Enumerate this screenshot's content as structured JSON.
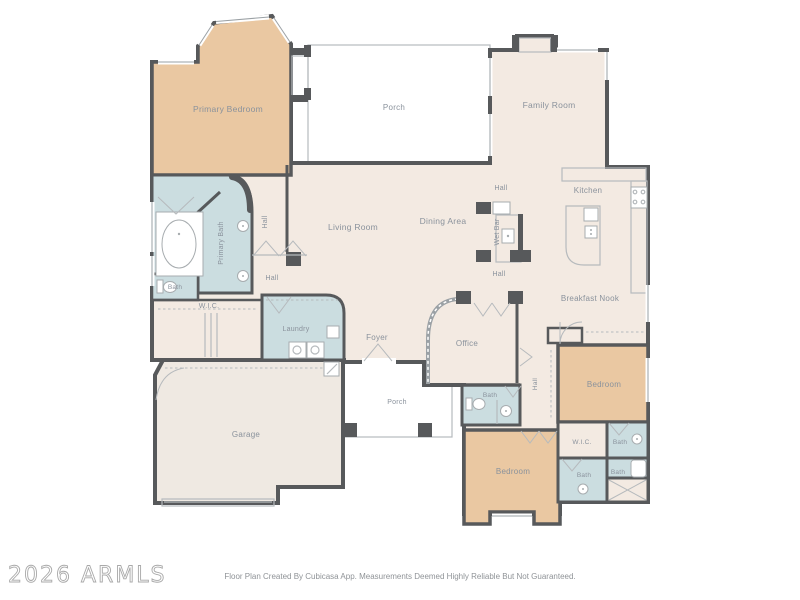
{
  "colors": {
    "floor_cream": "#f3eae2",
    "floor_tan": "#eac8a2",
    "floor_blue": "#cbdde0",
    "floor_porch": "#e7e9ea",
    "floor_garage": "#efe9e2",
    "wall": "#57595b",
    "label_text": "#8a929c",
    "line_light": "#b6babd",
    "fixture": "#a7acaf",
    "window": "#9aa0a4",
    "watermark": "#a9a9a9",
    "footer_text": "#8f9397"
  },
  "rooms": {
    "primary_bedroom": {
      "label": "Primary Bedroom"
    },
    "porch_top": {
      "label": "Porch"
    },
    "family_room": {
      "label": "Family Room"
    },
    "kitchen": {
      "label": "Kitchen"
    },
    "living_room": {
      "label": "Living Room"
    },
    "dining_area": {
      "label": "Dining Area"
    },
    "wet_bar": {
      "label": "Wet Bar"
    },
    "breakfast_nook": {
      "label": "Breakfast Nook"
    },
    "primary_bath": {
      "label": "Primary Bath"
    },
    "primary_wc": {
      "label": "Bath"
    },
    "primary_wic": {
      "label": "W.I.C."
    },
    "laundry": {
      "label": "Laundry"
    },
    "foyer": {
      "label": "Foyer"
    },
    "office": {
      "label": "Office"
    },
    "garage": {
      "label": "Garage"
    },
    "porch_bottom": {
      "label": "Porch"
    },
    "hall_bath": {
      "label": "Bath"
    },
    "bedroom_right": {
      "label": "Bedroom"
    },
    "bedroom_bottom": {
      "label": "Bedroom"
    },
    "wic_right": {
      "label": "W.I.C."
    },
    "bath_right_top": {
      "label": "Bath"
    },
    "bath_right_mid": {
      "label": "Bath"
    },
    "bath_right_low": {
      "label": "Bath"
    }
  },
  "halls": [
    {
      "label": "Hall"
    },
    {
      "label": "Hall"
    },
    {
      "label": "Hall"
    },
    {
      "label": "Hall"
    },
    {
      "label": "Hall"
    }
  ],
  "footer": {
    "watermark": "2026 ARMLS",
    "disclaimer": "Floor Plan Created By Cubicasa App. Measurements Deemed Highly Reliable But Not Guaranteed."
  }
}
